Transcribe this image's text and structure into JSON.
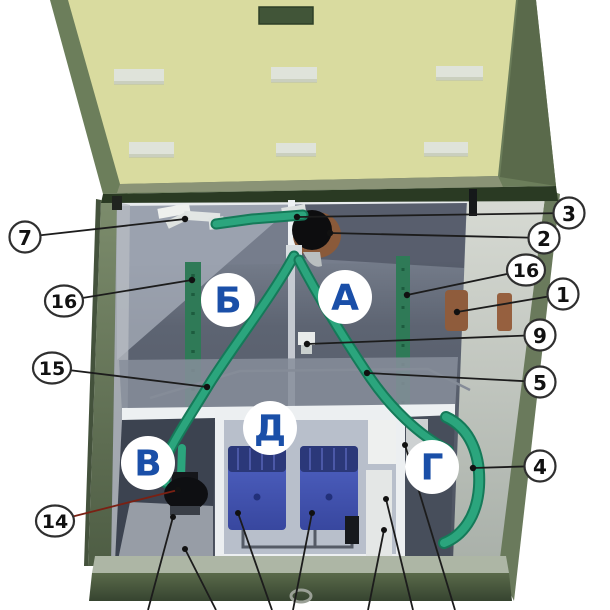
{
  "diagram": {
    "type": "technical-cutaway",
    "subject": "septic-treatment-unit-top-view-open-lid",
    "chamber_labels": [
      {
        "letter": "Б",
        "x": 228,
        "y": 300
      },
      {
        "letter": "А",
        "x": 345,
        "y": 297
      },
      {
        "letter": "В",
        "x": 148,
        "y": 463
      },
      {
        "letter": "Д",
        "x": 270,
        "y": 428
      },
      {
        "letter": "Г",
        "x": 432,
        "y": 467
      }
    ],
    "callouts": [
      {
        "num": "7",
        "cx": 25,
        "cy": 237,
        "tx": 185,
        "ty": 219
      },
      {
        "num": "16",
        "cx": 64,
        "cy": 301,
        "tx": 192,
        "ty": 280
      },
      {
        "num": "15",
        "cx": 52,
        "cy": 368,
        "tx": 207,
        "ty": 387
      },
      {
        "num": "14",
        "cx": 55,
        "cy": 521,
        "tx": 178,
        "ty": 490,
        "line_color": "#7a2013"
      },
      {
        "num": "3",
        "cx": 569,
        "cy": 213,
        "tx": 297,
        "ty": 217
      },
      {
        "num": "2",
        "cx": 544,
        "cy": 238,
        "tx": 330,
        "ty": 233
      },
      {
        "num": "16",
        "cx": 526,
        "cy": 270,
        "tx": 407,
        "ty": 295
      },
      {
        "num": "1",
        "cx": 563,
        "cy": 294,
        "tx": 457,
        "ty": 312
      },
      {
        "num": "9",
        "cx": 540,
        "cy": 335,
        "tx": 307,
        "ty": 344
      },
      {
        "num": "5",
        "cx": 540,
        "cy": 382,
        "tx": 367,
        "ty": 373
      },
      {
        "num": "4",
        "cx": 540,
        "cy": 466,
        "tx": 473,
        "ty": 468
      }
    ],
    "leader_lines_bottom": [
      {
        "x1": 173,
        "y1": 517,
        "x2": 148,
        "y2": 610
      },
      {
        "x1": 185,
        "y1": 549,
        "x2": 216,
        "y2": 610
      },
      {
        "x1": 238,
        "y1": 513,
        "x2": 272,
        "y2": 610
      },
      {
        "x1": 312,
        "y1": 513,
        "x2": 293,
        "y2": 610
      },
      {
        "x1": 386,
        "y1": 499,
        "x2": 413,
        "y2": 610
      },
      {
        "x1": 384,
        "y1": 530,
        "x2": 368,
        "y2": 610
      },
      {
        "x1": 405,
        "y1": 445,
        "x2": 455,
        "y2": 610
      }
    ]
  },
  "colors": {
    "pipe_green": "#2ba57d",
    "pipe_green_dark": "#157a59",
    "lid_yellow": "#d9db9f",
    "lid_frame_green": "#6c7e5b",
    "tank_green": "#5f7054",
    "letter_blue": "#1a4fa8",
    "compressor_blue": "#4a5bbf",
    "coupling_brown": "#8f5c3c",
    "callout_line": "#1c1c1c",
    "callout_line_red": "#7a2013"
  }
}
